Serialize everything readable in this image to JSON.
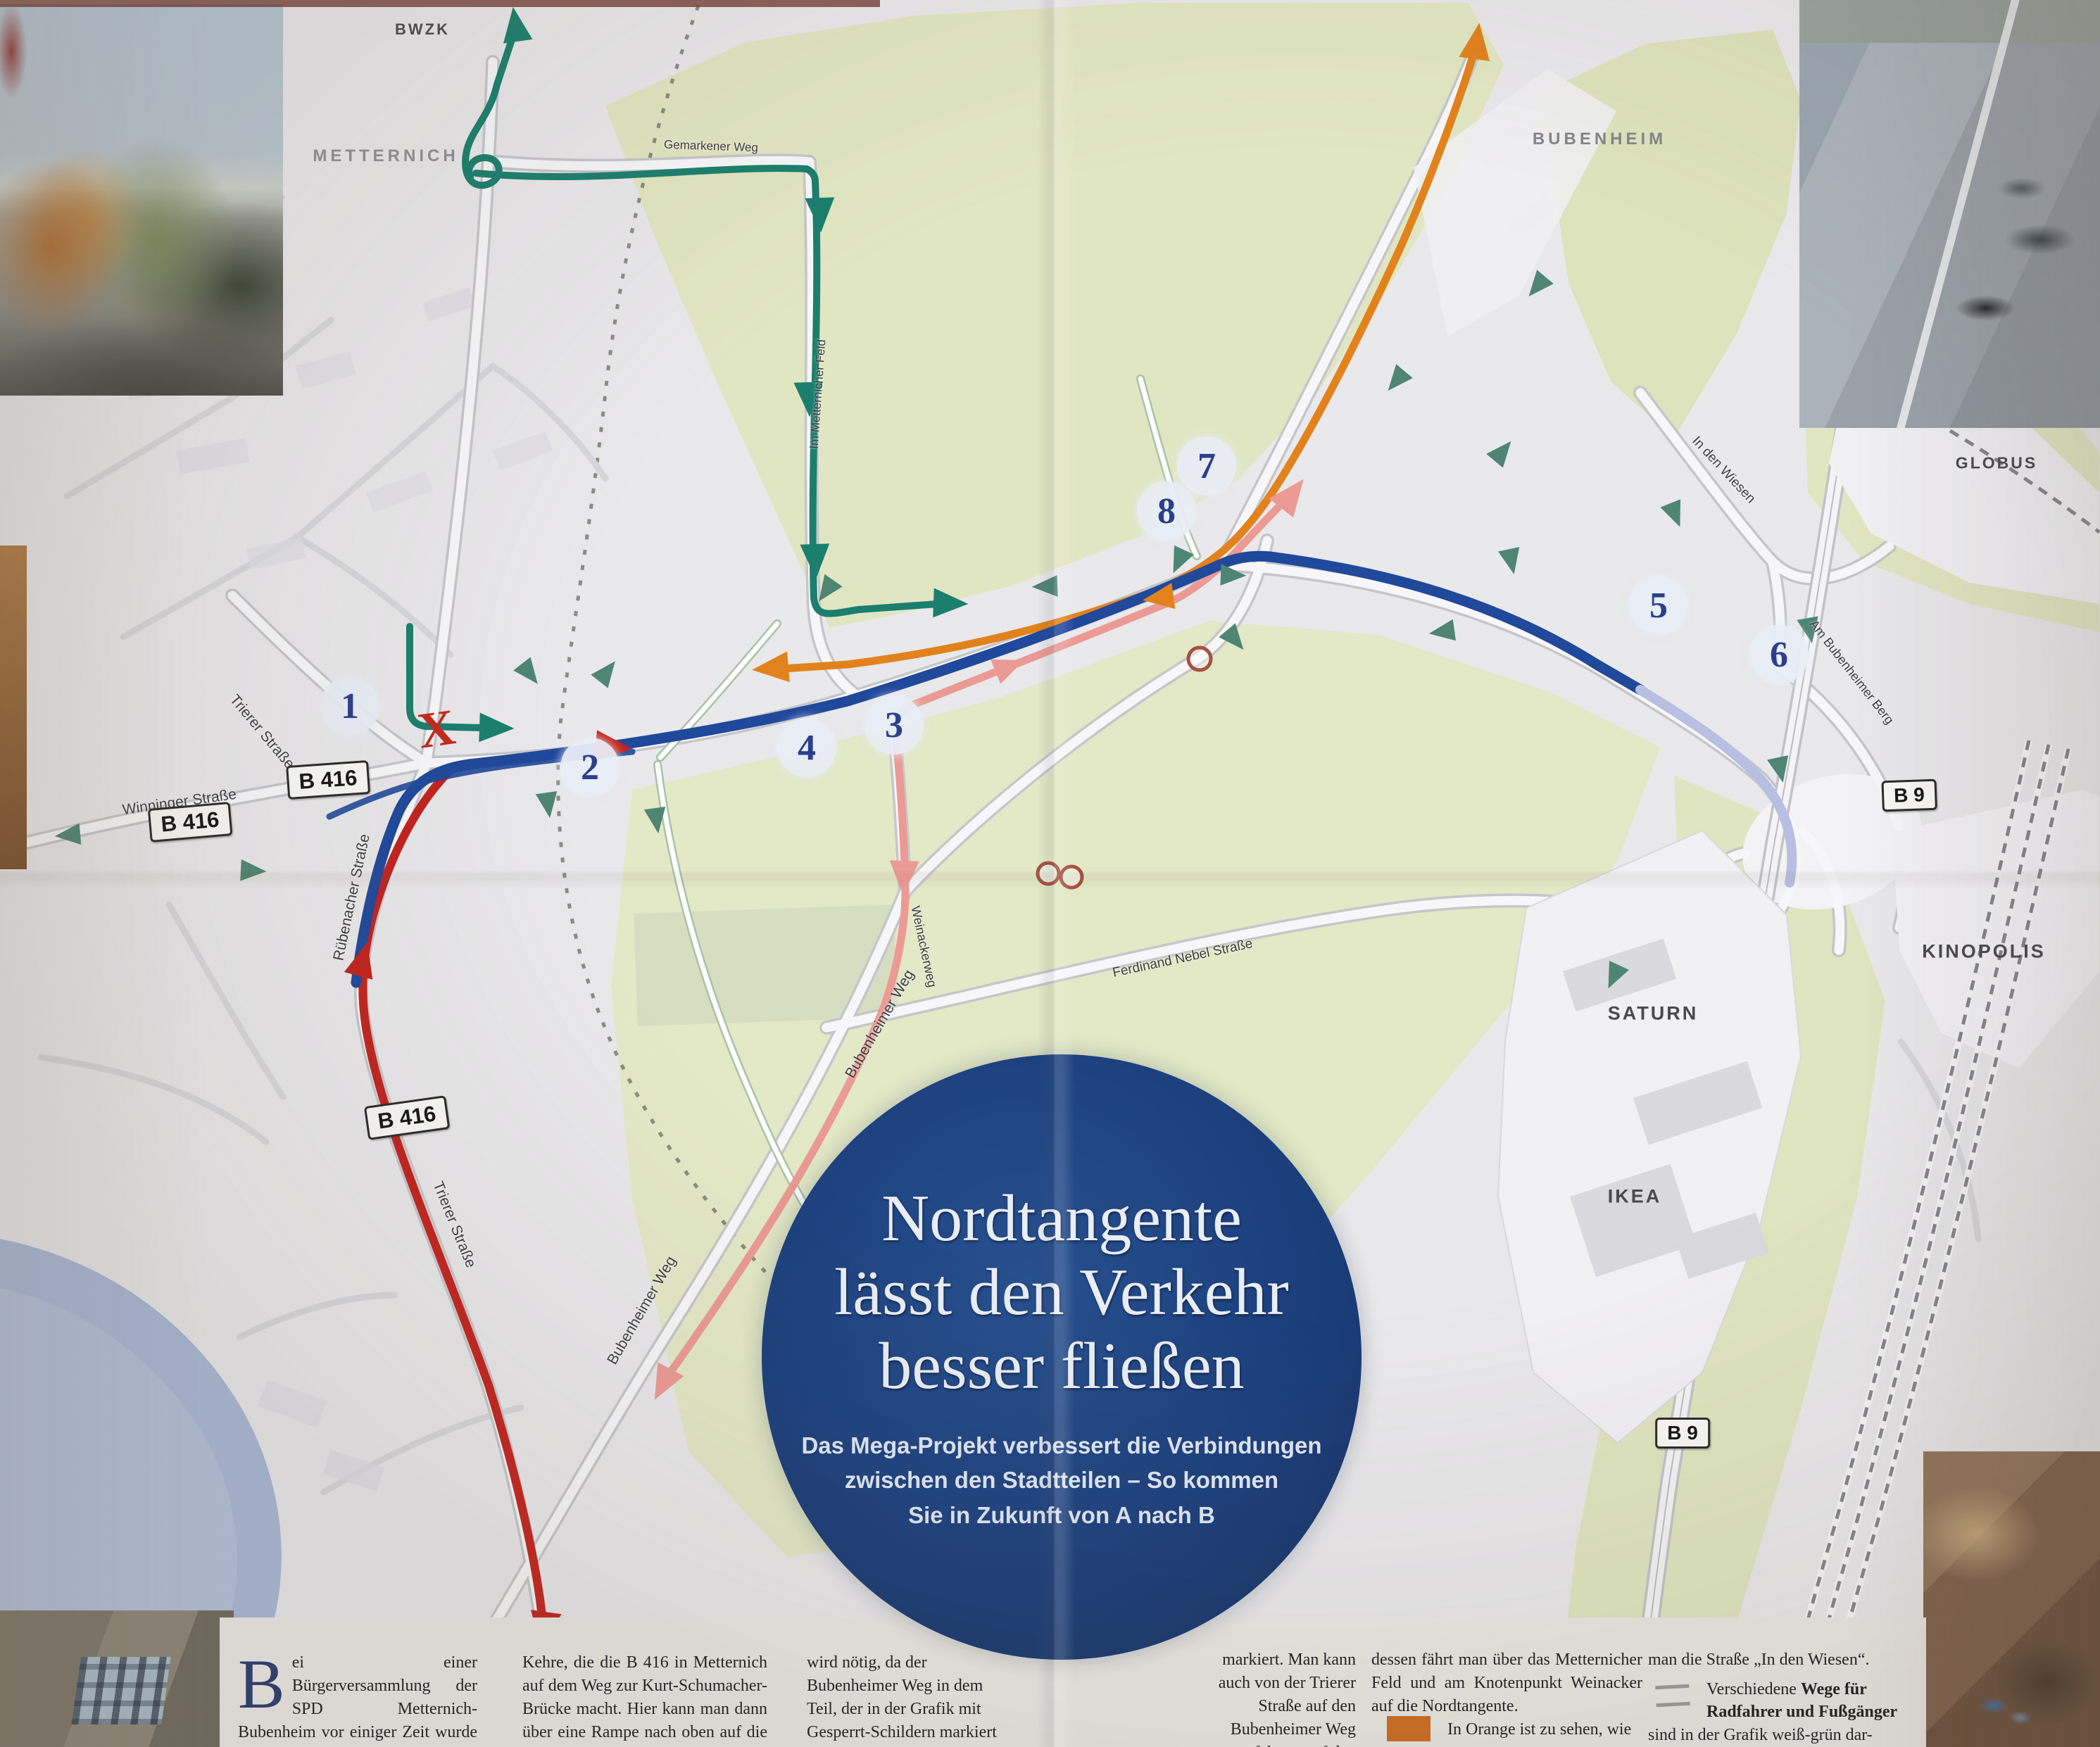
{
  "map": {
    "title_circle": {
      "title_lines": [
        "Nordtangente",
        "lässt den Verkehr",
        "besser fließen"
      ],
      "subtitle_lines": [
        "Das Mega-Projekt verbessert die Verbindungen",
        "zwischen den Stadtteilen – So kommen",
        "Sie in Zukunft von A nach B"
      ]
    },
    "place_labels": [
      {
        "id": "bwzk",
        "text": "BWZK"
      },
      {
        "id": "metternich",
        "text": "METTERNICH"
      },
      {
        "id": "bubenheim",
        "text": "BUBENHEIM"
      },
      {
        "id": "globus",
        "text": "GLOBUS"
      },
      {
        "id": "kinopolis",
        "text": "KINOPOLIS"
      },
      {
        "id": "saturn",
        "text": "SATURN"
      },
      {
        "id": "ikea",
        "text": "IKEA"
      }
    ],
    "street_labels": [
      {
        "text": "Winninger Straße"
      },
      {
        "text": "Trierer Straße"
      },
      {
        "text": "Rübenacher Straße"
      },
      {
        "text": "Trierer Straße"
      },
      {
        "text": "Bubenheimer Weg"
      },
      {
        "text": "Bubenheimer Weg"
      },
      {
        "text": "Weinackerweg"
      },
      {
        "text": "Ferdinand Nebel Straße"
      },
      {
        "text": "Im Metternicher Feld"
      },
      {
        "text": "Gemarkener Weg"
      },
      {
        "text": "In den Wiesen"
      },
      {
        "text": "Am Bubenheimer Berg"
      }
    ],
    "road_shields": [
      {
        "text": "B 416"
      },
      {
        "text": "B 416"
      },
      {
        "text": "B 416"
      },
      {
        "text": "B 9"
      },
      {
        "text": "B 9"
      }
    ],
    "markers": [
      {
        "label": "1"
      },
      {
        "label": "2"
      },
      {
        "label": "3"
      },
      {
        "label": "4"
      },
      {
        "label": "5"
      },
      {
        "label": "6"
      },
      {
        "label": "7"
      },
      {
        "label": "8"
      }
    ],
    "closed_x": "X",
    "route_colors": {
      "nordtangente_blue": "#20489b",
      "planned_lavender": "#b9bfe2",
      "teal_green": "#1b7f6d",
      "red": "#c2231e",
      "pink": "#ec9a94",
      "orange": "#e2821c",
      "bike_arrow_green": "#4f8573",
      "closed_ring": "#a85040"
    }
  },
  "article": {
    "drop_cap": "B",
    "columns": [
      {
        "text": "ei einer Bürgerversammlung der SPD Metternich-Bubenheim vor einiger Zeit wurde deutlich: Was die Menschen bei dem Projekt Nordtangente vor"
      },
      {
        "text": "Kehre, die die B 416 in Metternich auf dem Weg zur Kurt-Schumacher-Brücke macht. Hier kann man dann über eine Rampe nach oben auf die Rübenacher Straße fahren oder"
      },
      {
        "text": "wird nötig, da der Bubenheimer Weg in dem Teil, der in der Grafik mit Gesperrt-Schildern markiert ist, nicht befah-"
      },
      {
        "text": "markiert. Man kann auch von der Trierer Straße auf den Bubenheimer Weg fahren, auf den Weinackerweg und"
      },
      {
        "text": "dessen fährt man über das Metternicher Feld und am Knotenpunkt Weinacker auf die Nordtangente."
      },
      {
        "text": "man die Straße „In den Wiesen“."
      }
    ],
    "legend": {
      "orange_text": "In Orange ist zu sehen, wie",
      "paths_prefix": "Verschiedene ",
      "paths_bold": "Wege für Radfahrer und Fußgänger",
      "paths_suffix": "sind in der Grafik weiß-grün dar-"
    }
  }
}
